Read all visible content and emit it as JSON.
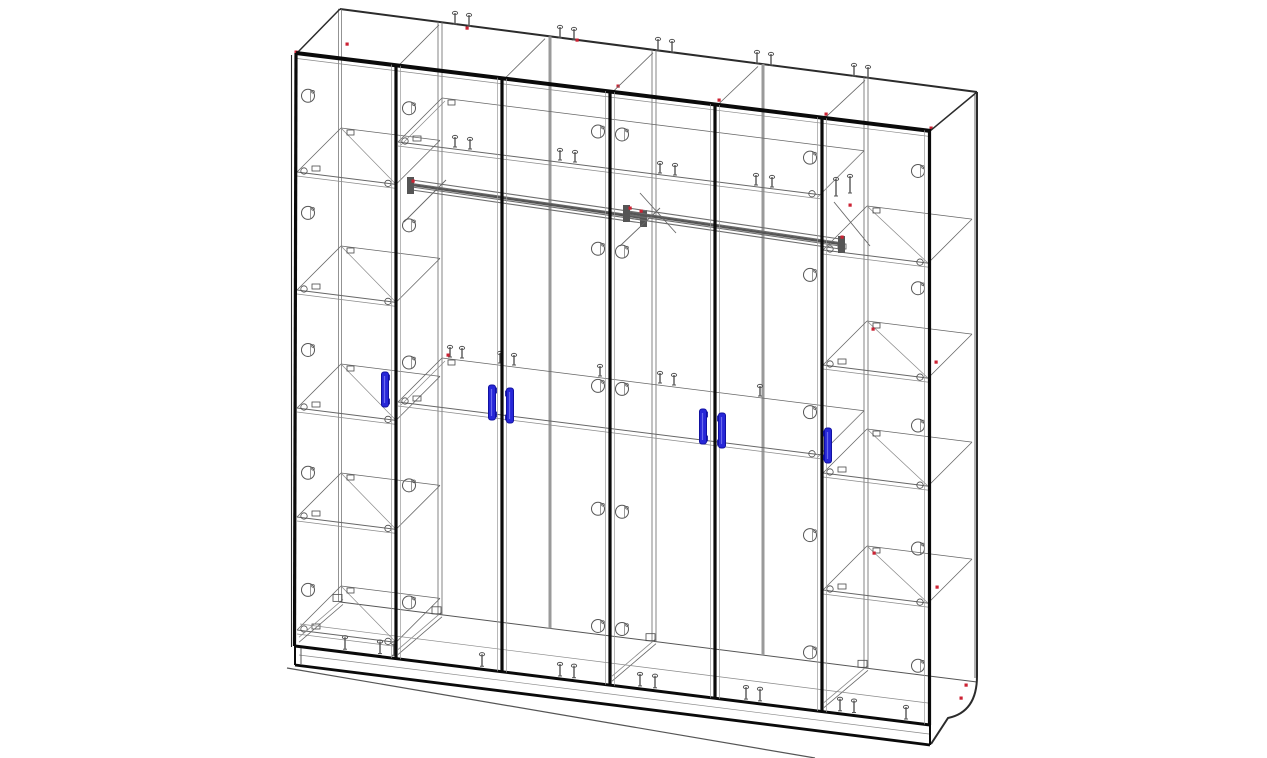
{
  "drawing": {
    "title": "wardrobe-6-door-assembly-wireframe",
    "colors": {
      "black": "#0a0a0a",
      "dark": "#2b2b2b",
      "medium": "#555555",
      "thin": "#666666",
      "light": "#8a8a8a",
      "faint": "#9a9a9a",
      "partition": "#787878",
      "joint": "#9a9a9a",
      "rod": "#6e6e6e",
      "fitting": "#4a4a4a",
      "handle_fill": "#2727d8",
      "handle_stroke": "#1111a0",
      "red": "#cc2233",
      "background": "#ffffff"
    },
    "frame": {
      "front_top_left": [
        297,
        53
      ],
      "front_top_right": [
        930,
        131
      ],
      "front_bottom_left": [
        295,
        646
      ],
      "front_bottom_right": [
        930,
        725
      ],
      "back_top_left": [
        340,
        9
      ],
      "back_top_right": [
        977,
        92
      ],
      "back_bottom_left": [
        340,
        602
      ],
      "back_bottom_right": [
        977,
        682
      ],
      "plinth_bottom_left": [
        295,
        665
      ],
      "plinth_bottom_right": [
        930,
        745
      ],
      "right_outer_x": 977,
      "right_inner_x": 975,
      "curve_start_y": 676,
      "floor_line": [
        287,
        668,
        815,
        758
      ]
    },
    "depth": {
      "dx": 44,
      "dy": -44
    },
    "shelf_slope": 0.125,
    "boundaries": [
      {
        "x": 396,
        "partition": true
      },
      {
        "x": 502,
        "partition": false
      },
      {
        "x": 610,
        "partition": true
      },
      {
        "x": 715,
        "partition": false
      },
      {
        "x": 822,
        "partition": true
      }
    ],
    "bays": {
      "left_shelves": {
        "x1": 297,
        "x2": 396,
        "ys": [
          172,
          290,
          408,
          517,
          630
        ]
      },
      "right_shelves": {
        "x1": 823,
        "x2": 928,
        "ys": [
          250,
          365,
          473,
          590
        ]
      },
      "middle_shelves": [
        {
          "x1": 398,
          "x2": 820,
          "y": 142
        },
        {
          "x1": 398,
          "x2": 820,
          "y": 402
        }
      ]
    },
    "rods": [
      {
        "x1": 412,
        "y1": 180,
        "x2": 642,
        "y2": 213
      },
      {
        "x1": 628,
        "y1": 208,
        "x2": 840,
        "y2": 239
      }
    ],
    "braces": [
      [
        640,
        193,
        676,
        233
      ],
      [
        834,
        202,
        870,
        246
      ],
      [
        404,
        222,
        446,
        180
      ],
      [
        620,
        246,
        660,
        208
      ]
    ],
    "handles": {
      "width": 7,
      "height": 35,
      "items": [
        {
          "x": 385,
          "y": 372,
          "feet": 1
        },
        {
          "x": 492,
          "y": 385,
          "feet": 1
        },
        {
          "x": 510,
          "y": 388,
          "feet": -1
        },
        {
          "x": 703,
          "y": 409,
          "feet": 1
        },
        {
          "x": 722,
          "y": 413,
          "feet": -1
        },
        {
          "x": 828,
          "y": 428,
          "feet": -1
        }
      ]
    },
    "hinge_stiles": [
      308,
      409,
      598,
      622,
      810,
      918
    ],
    "hinge_fractions": [
      0.055,
      0.26,
      0.5,
      0.715,
      0.92
    ],
    "screws": {
      "top": [
        [
          455,
          24
        ],
        [
          469,
          26
        ],
        [
          560,
          38
        ],
        [
          574,
          40
        ],
        [
          658,
          50
        ],
        [
          672,
          52
        ],
        [
          757,
          63
        ],
        [
          771,
          65
        ],
        [
          854,
          76
        ],
        [
          868,
          78
        ]
      ],
      "upper": [
        [
          455,
          147
        ],
        [
          470,
          149
        ],
        [
          560,
          160
        ],
        [
          575,
          162
        ],
        [
          660,
          173
        ],
        [
          675,
          175
        ],
        [
          756,
          185
        ],
        [
          772,
          187
        ],
        [
          836,
          196
        ],
        [
          850,
          193
        ]
      ],
      "mid": [
        [
          450,
          357
        ],
        [
          462,
          358
        ],
        [
          500,
          363
        ],
        [
          514,
          365
        ],
        [
          600,
          376
        ],
        [
          660,
          383
        ],
        [
          674,
          385
        ],
        [
          760,
          396
        ]
      ],
      "bottom_x": [
        345,
        380,
        394,
        482,
        560,
        574,
        640,
        655,
        746,
        760,
        840,
        854,
        906
      ]
    },
    "red_marks": [
      [
        347,
        44
      ],
      [
        467,
        28
      ],
      [
        577,
        40
      ],
      [
        618,
        86
      ],
      [
        719,
        100
      ],
      [
        826,
        114
      ],
      [
        931,
        128
      ],
      [
        873,
        329
      ],
      [
        936,
        362
      ],
      [
        874,
        553
      ],
      [
        937,
        587
      ],
      [
        966,
        685
      ],
      [
        961,
        698
      ],
      [
        413,
        181
      ],
      [
        641,
        211
      ],
      [
        630,
        208
      ],
      [
        842,
        237
      ],
      [
        448,
        355
      ],
      [
        850,
        205
      ],
      [
        296,
        52
      ]
    ]
  }
}
